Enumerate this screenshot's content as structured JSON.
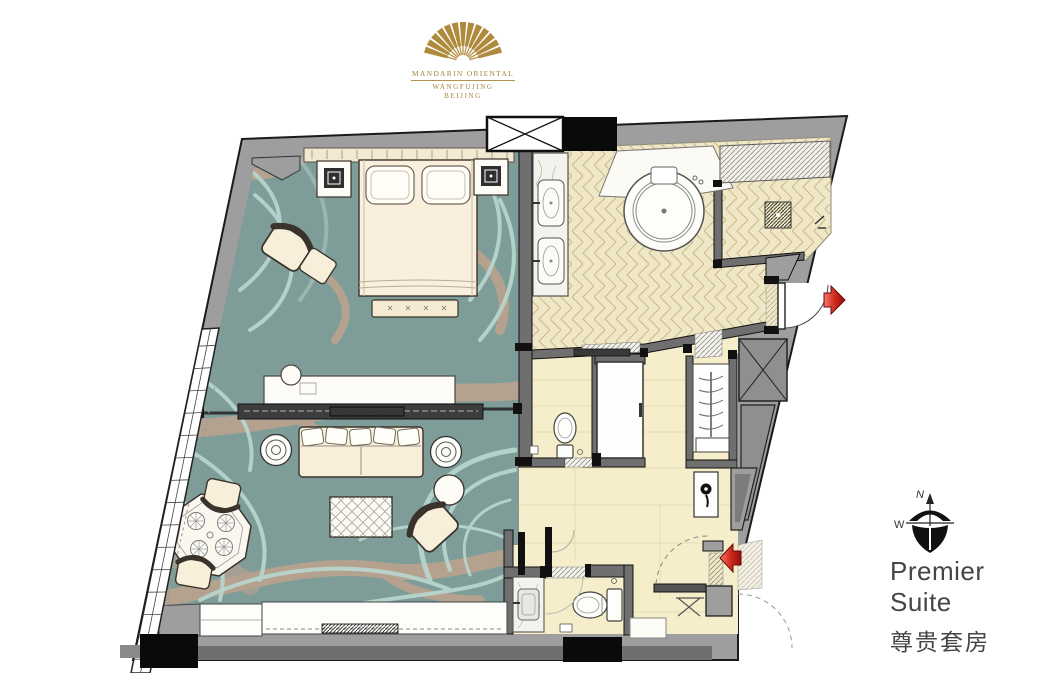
{
  "brand": {
    "logo_icon": "fan-icon",
    "line1": "MANDARIN ORIENTAL",
    "line2": "WANGFUJING",
    "line3": "BEIJING",
    "gold_color": "#a8853e"
  },
  "plan_label": {
    "title_en": "Premier Suite",
    "title_zh": "尊贵套房"
  },
  "compass": {
    "icon": "compass-icon",
    "north": "N",
    "west": "W"
  },
  "markers": {
    "entry_arrow_icon": "red-entry-arrow",
    "side_door_arrow_icon": "red-side-door-arrow",
    "accent_red": "#c01818"
  },
  "colors": {
    "carpet": "#7e9c98",
    "carpet_swirl": "#b9d8d0",
    "carpet_branch": "#c2a48e",
    "bath_tile": "#efe7c5",
    "tile_line": "#c9b98e",
    "stone_floor": "#f6eeca",
    "wall_gray": "#9e9e9e",
    "wall_dark": "#6f6f6f",
    "outline": "#1a1a1a",
    "furniture_cream": "#f8efdb",
    "marble": "#f4f2ec",
    "text": "#454545"
  }
}
